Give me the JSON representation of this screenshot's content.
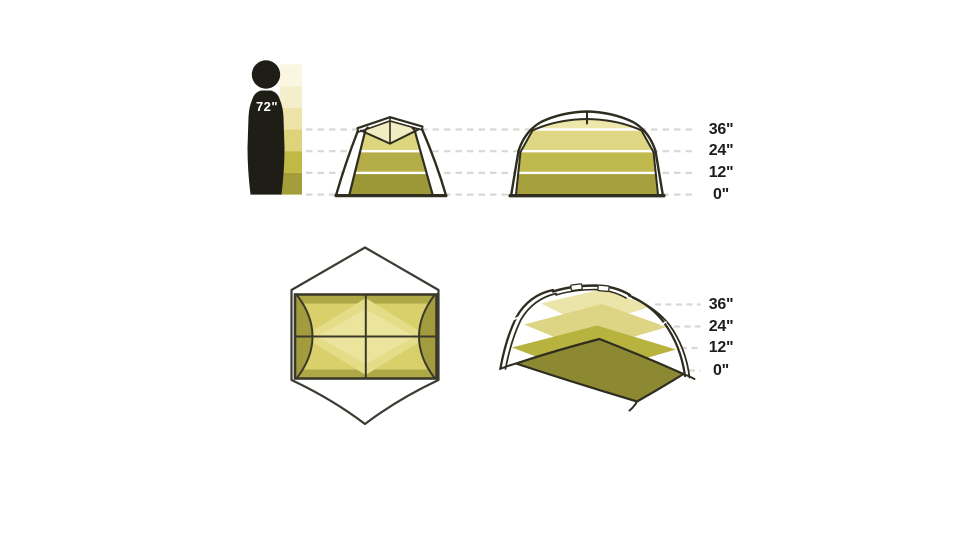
{
  "figure": {
    "label": "72\""
  },
  "scale": {
    "labels": [
      "36\"",
      "24\"",
      "12\"",
      "0\""
    ]
  },
  "palette": {
    "background": "#ffffff",
    "ink": "#2e2d20",
    "outline_gray": "#3c3b33",
    "silhouette": "#1f1e16",
    "label_text": "#1d1d1b",
    "figure_label_text": "#ffffff",
    "grid_dash": "#d8d8d4",
    "separator_white": "#ffffff",
    "bar_bands": [
      "#faf6e2",
      "#f5eecb",
      "#eee4a9",
      "#ded37a",
      "#c0b944",
      "#a39e3b"
    ],
    "tent_front": {
      "cap": "#f2ecc2",
      "upper": "#ded67e",
      "mid": "#b5ae48",
      "lower": "#9c9737"
    },
    "tent_side": {
      "cap": "#eee7ab",
      "upper": "#ded683",
      "mid": "#c0b94e",
      "lower": "#a5a03c"
    },
    "plan": {
      "base": "#d9d06c",
      "end_cap": "#a29c3e",
      "band_dark": "#aaa342",
      "diamond_light": "#e4dc86",
      "diamond_lighter": "#ebe49c",
      "line": "#3b3a2a"
    },
    "perspective": {
      "ground": "#8d8832",
      "plane_12": "#b8b23e",
      "plane_24": "#ddd584",
      "plane_36": "#ece5a9"
    }
  }
}
